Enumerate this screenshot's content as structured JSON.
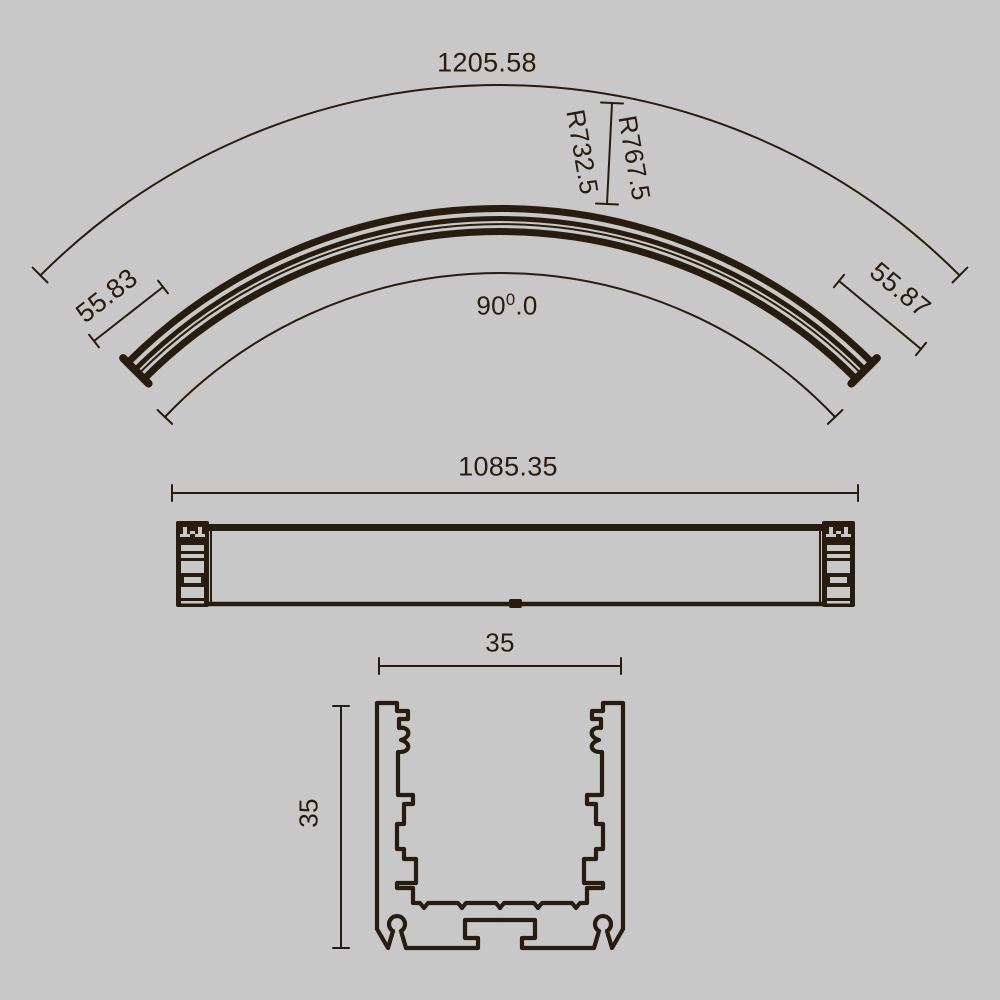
{
  "palette": {
    "background": "#c8c8c8",
    "ink": "#281c0e"
  },
  "curved_view": {
    "arc_length": "1205.58",
    "outer_radius": "R767.5",
    "inner_radius": "R732.5",
    "left_end_length": "55.83",
    "right_end_length": "55.87",
    "angle_base": "90",
    "angle_superscript": "0",
    "angle_fraction": ".0"
  },
  "straight_view": {
    "length": "1085.35"
  },
  "section_view": {
    "width": "35",
    "height": "35"
  }
}
